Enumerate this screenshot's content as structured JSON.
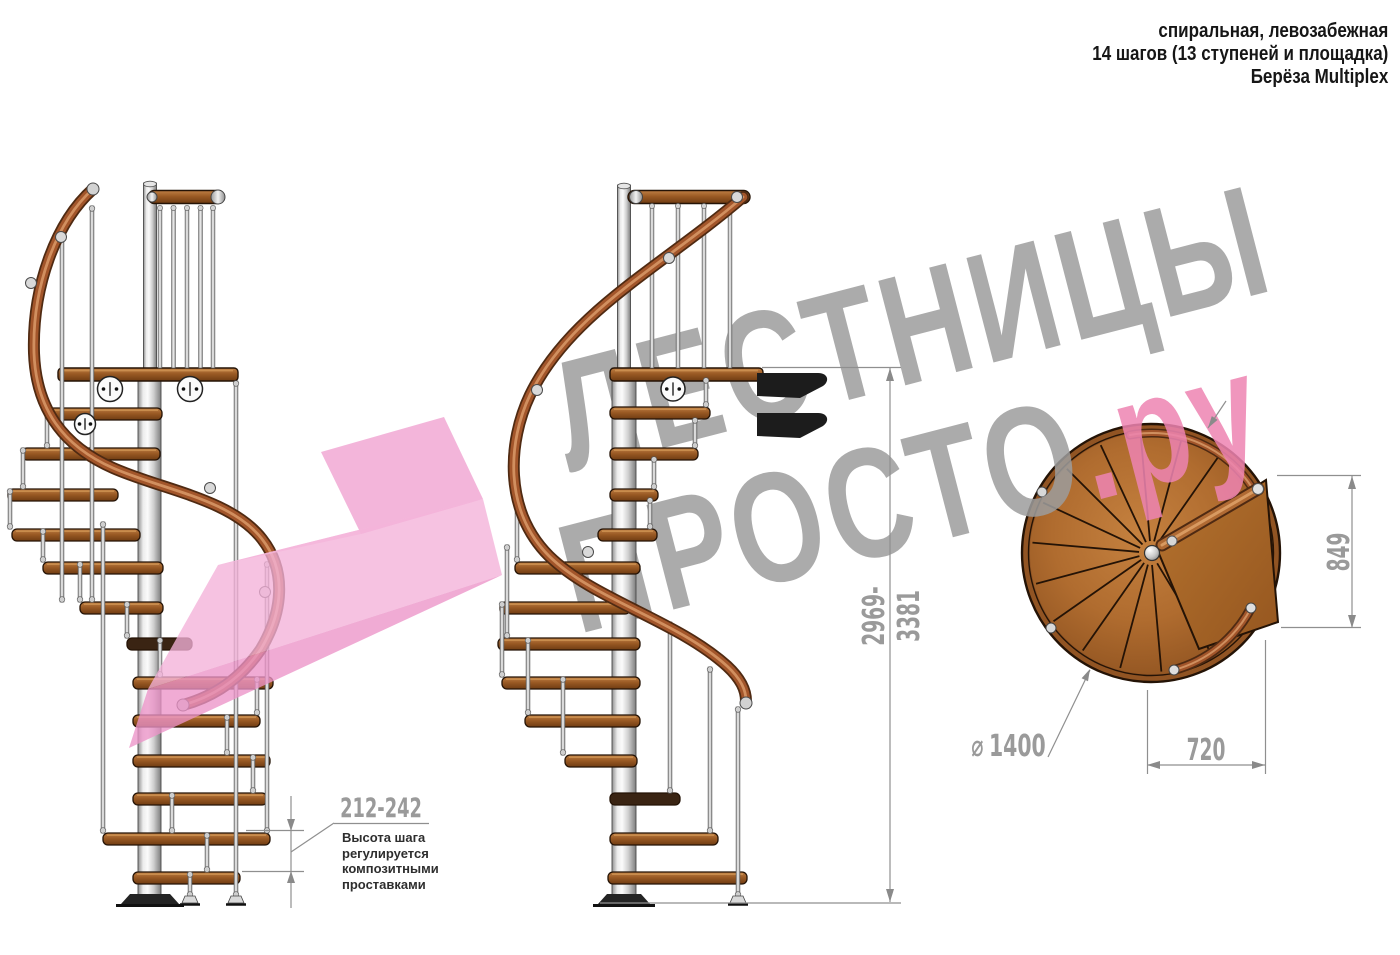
{
  "header": {
    "lines": [
      "спиральная, левозабежная",
      "14 шагов (13 ступеней и площадка)",
      "Берёза Multiplex"
    ]
  },
  "watermark": {
    "line1": "ЛЕСТНИЦЫ",
    "line2_main": "ПРОСТО",
    "line2_accent": ".ру"
  },
  "dimensions": {
    "total_height": "2969-3381",
    "step_height": "212-242",
    "landing_depth": "849",
    "passage_width": "720",
    "diameter_symbol": "⌀",
    "diameter_value": "1400"
  },
  "annotation": {
    "lines": [
      "Высота шага",
      "регулируется",
      "композитными",
      "проставками"
    ]
  },
  "colors": {
    "watermark_gray": "#9d9d9d",
    "accent_pink": "#ee84b2",
    "logo_pink": "#f2a9d6",
    "dimension_gray": "#9a9a9a",
    "wood_brown": "#a96a2e",
    "handrail_brown": "#a2552a",
    "metal_silver": "#d9d9d9"
  }
}
